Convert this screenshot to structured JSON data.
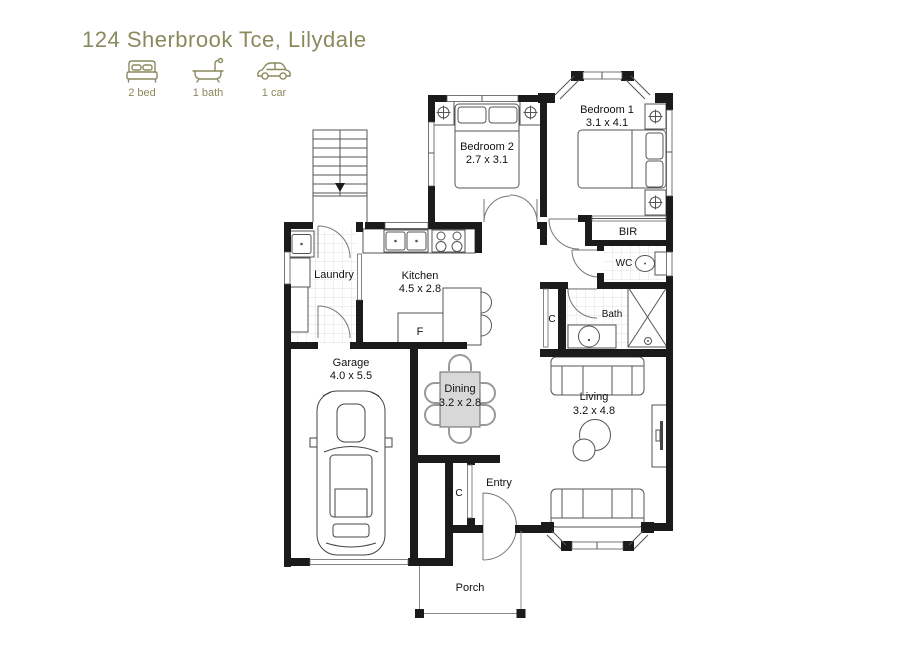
{
  "header": {
    "title": "124 Sherbrook Tce, Lilydale"
  },
  "features": [
    {
      "icon": "bed-icon",
      "label": "2 bed"
    },
    {
      "icon": "bath-icon",
      "label": "1 bath"
    },
    {
      "icon": "car-icon",
      "label": "1 car"
    }
  ],
  "rooms": {
    "bedroom1": {
      "name": "Bedroom 1",
      "dims": "3.1 x 4.1"
    },
    "bedroom2": {
      "name": "Bedroom 2",
      "dims": "2.7 x 3.1"
    },
    "kitchen": {
      "name": "Kitchen",
      "dims": "4.5 x 2.8"
    },
    "laundry": {
      "name": "Laundry"
    },
    "garage": {
      "name": "Garage",
      "dims": "4.0 x 5.5"
    },
    "dining": {
      "name": "Dining",
      "dims": "3.2 x 2.8"
    },
    "living": {
      "name": "Living",
      "dims": "3.2 x 4.8"
    },
    "bath": {
      "name": "Bath"
    },
    "wc": {
      "name": "WC"
    },
    "bir": {
      "name": "BIR"
    },
    "entry": {
      "name": "Entry"
    },
    "porch": {
      "name": "Porch"
    },
    "closet": {
      "label": "C"
    },
    "fridge": {
      "label": "F"
    }
  },
  "colors": {
    "accent": "#8a8a5f",
    "wall": "#1b1b1b"
  }
}
